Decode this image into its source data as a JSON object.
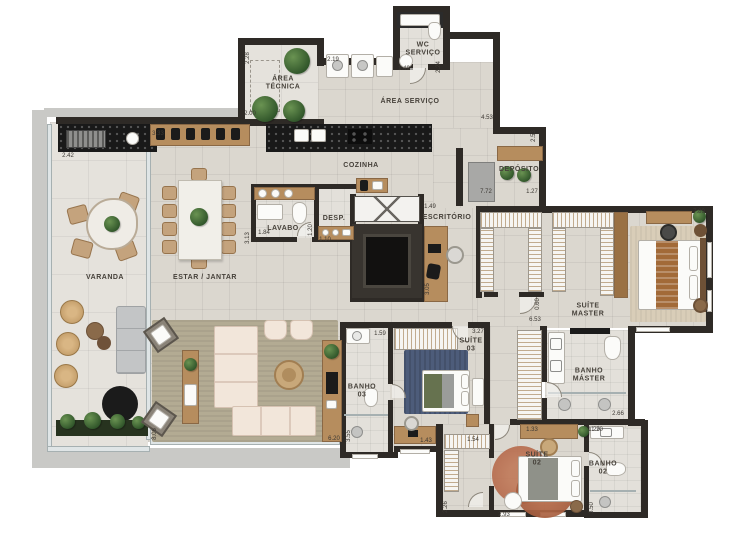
{
  "colors": {
    "wall": "#2e2a26",
    "floor": "#dbd7cf",
    "floor_varanda": "#e5e2dc",
    "floor_bath": "#e3e0da",
    "wood": "#b68d5e",
    "counter_black": "#1b1b1b",
    "sofa_cream": "#f2e6da",
    "rug_living": "#b3ab93",
    "rug_suite03": "#4d5c7a",
    "rug_suite02": "#b06245",
    "carpet_master": "#d9cdb8",
    "plant_green": "#3f6638",
    "sofa_gray": "#c3c5c6",
    "concrete": "#c9c9c6",
    "glass": "#dfe5e6",
    "label_text": "#46413a"
  },
  "rooms": [
    {
      "label": "VARANDA"
    },
    {
      "label": "ESTAR / JANTAR"
    },
    {
      "label": "COZINHA"
    },
    {
      "label": "ÁREA TÉCNICA"
    },
    {
      "label": "ÁREA SERVIÇO"
    },
    {
      "label": "WC SERVIÇO"
    },
    {
      "label": "DEPÓSITO"
    },
    {
      "label": "LAVABO"
    },
    {
      "label": "DESP."
    },
    {
      "label": "ESCRITÓRIO"
    },
    {
      "label": "SUÍTE MASTER"
    },
    {
      "label": "BANHO MÁSTER"
    },
    {
      "label": "SUÍTE 03"
    },
    {
      "label": "BANHO 03"
    },
    {
      "label": "SUÍTE 02"
    },
    {
      "label": "BANHO 02"
    }
  ],
  "dims": [
    {
      "v": "2.42"
    },
    {
      "v": "2.28"
    },
    {
      "v": "2.00"
    },
    {
      "v": "2.19"
    },
    {
      "v": "1.49"
    },
    {
      "v": "2.24"
    },
    {
      "v": "4.53"
    },
    {
      "v": "2.53"
    },
    {
      "v": "7.72"
    },
    {
      "v": "1.27"
    },
    {
      "v": "3.33"
    },
    {
      "v": "3.13"
    },
    {
      "v": "1.84"
    },
    {
      "v": "1.20"
    },
    {
      "v": "1.10"
    },
    {
      "v": "1.49"
    },
    {
      "v": "3.05"
    },
    {
      "v": "0.60"
    },
    {
      "v": "6.53"
    },
    {
      "v": "3.27"
    },
    {
      "v": "1.59"
    },
    {
      "v": "7.89"
    },
    {
      "v": "2.66"
    },
    {
      "v": "1.20"
    },
    {
      "v": "1.33"
    },
    {
      "v": "1.54"
    },
    {
      "v": "1.43"
    },
    {
      "v": "6.20"
    },
    {
      "v": "3.55"
    },
    {
      "v": "2.26"
    },
    {
      "v": "2.93"
    },
    {
      "v": "3.50"
    },
    {
      "v": "1.29"
    },
    {
      "v": "8.06"
    }
  ]
}
